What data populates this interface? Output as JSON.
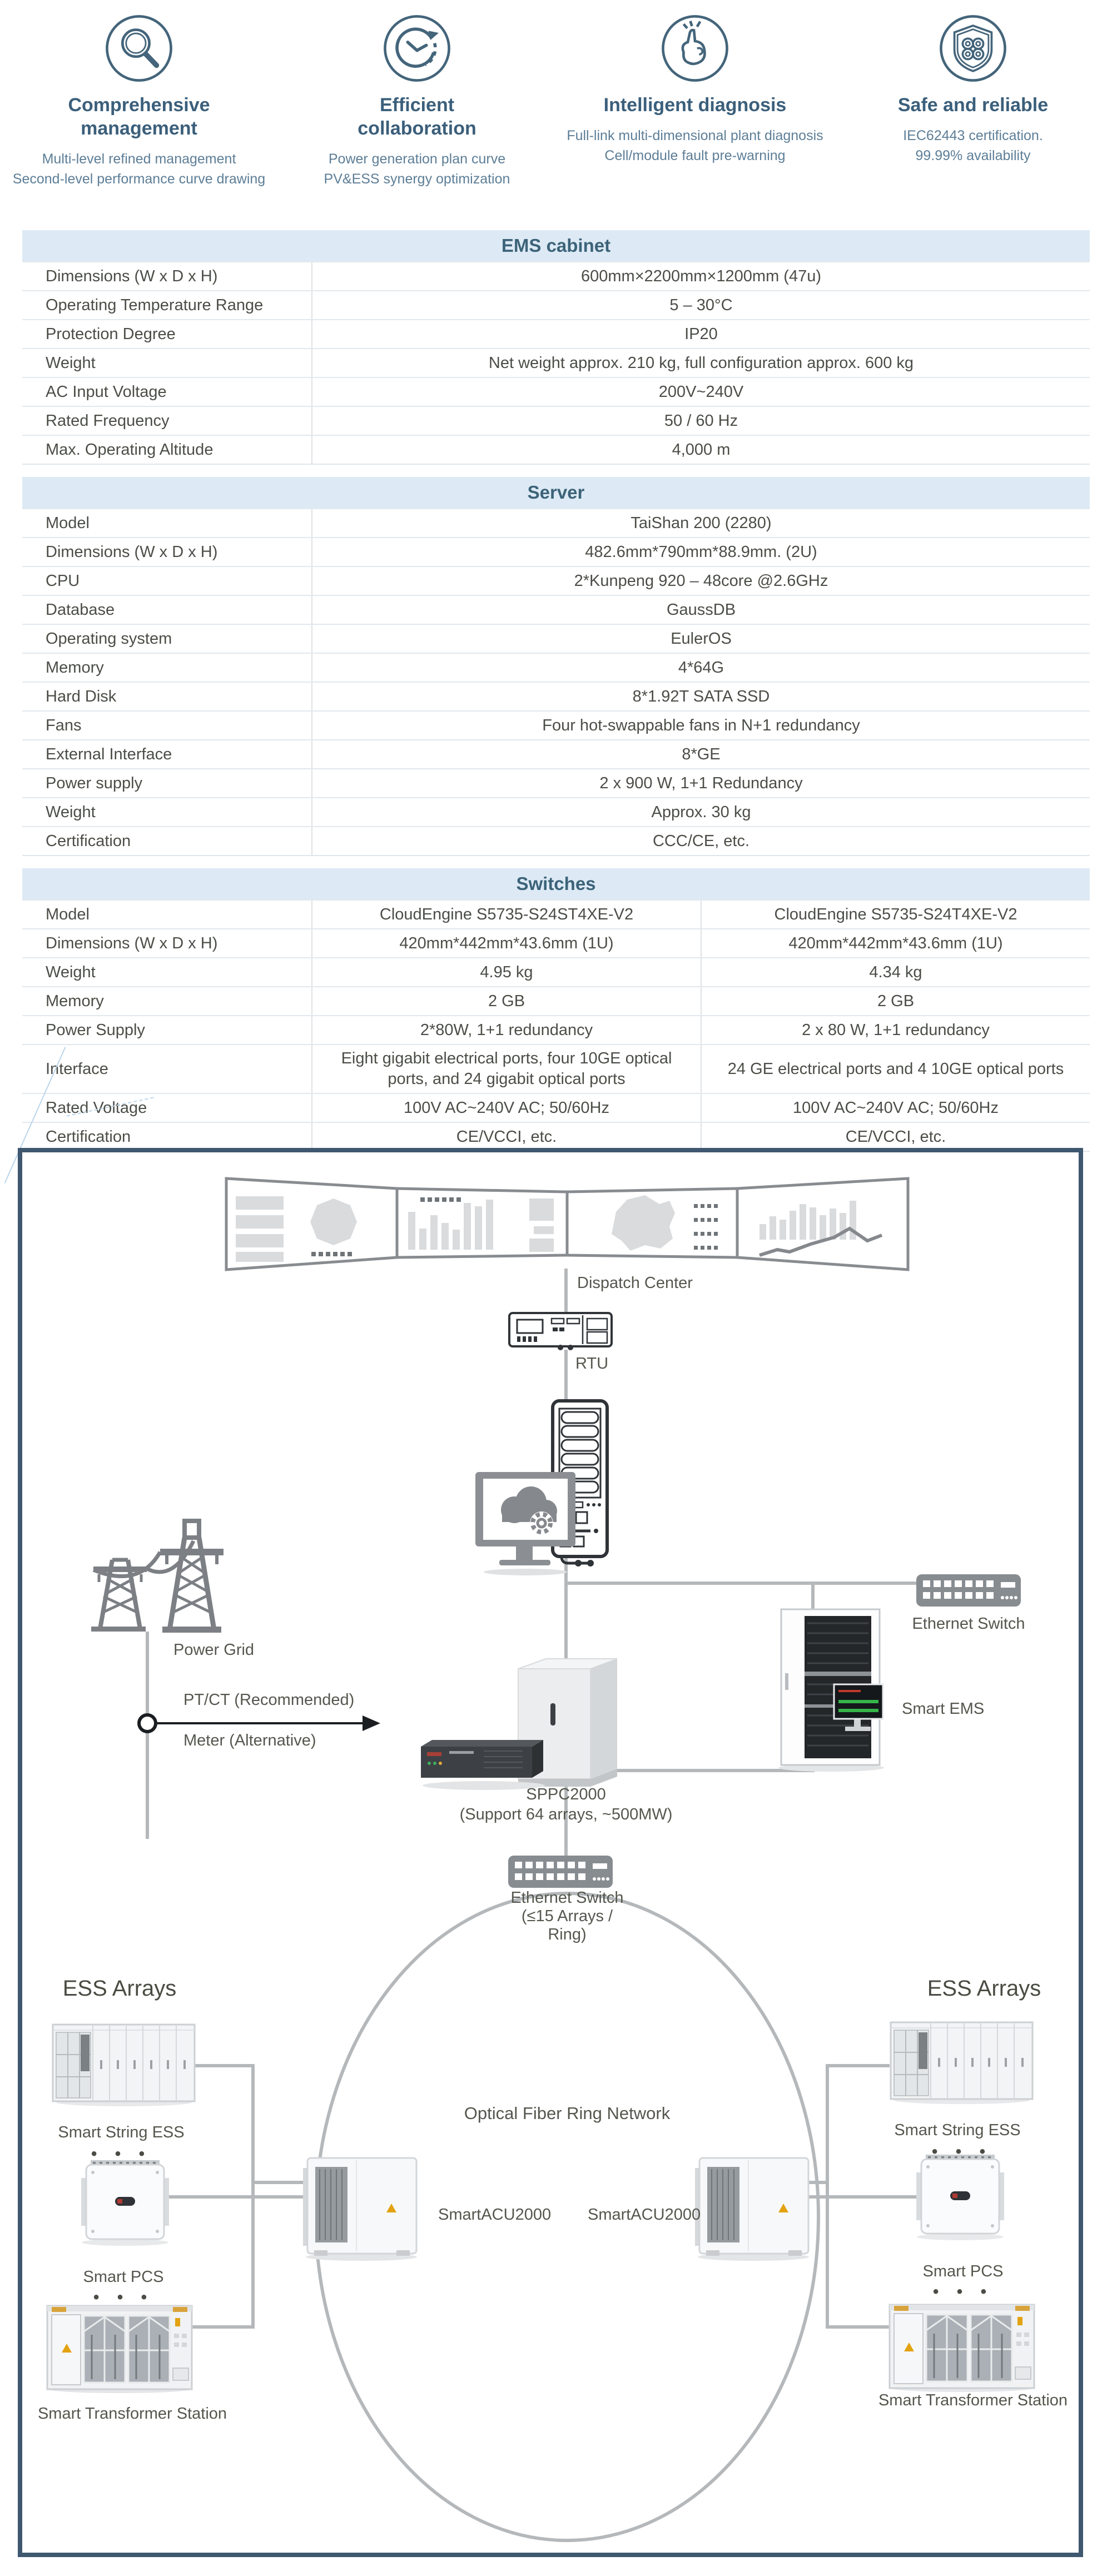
{
  "features": [
    {
      "icon": "magnifier-icon",
      "title": "Comprehensive management",
      "desc": "Multi-level refined management\nSecond-level performance curve drawing"
    },
    {
      "icon": "cycle-clock-icon",
      "title": "Efficient collaboration",
      "desc": "Power generation plan curve\nPV&ESS  synergy optimization"
    },
    {
      "icon": "snap-finger-icon",
      "title": "Intelligent diagnosis",
      "desc": "Full-link multi-dimensional plant diagnosis\nCell/module fault pre-warning"
    },
    {
      "icon": "shield-icon",
      "title": "Safe and reliable",
      "desc": "IEC62443 certification.\n99.99% availability"
    }
  ],
  "tables": {
    "ems": {
      "title": "EMS cabinet",
      "rows": [
        {
          "label": "Dimensions (W x D x H)",
          "value": "600mm×2200mm×1200mm (47u)"
        },
        {
          "label": "Operating Temperature Range",
          "value": "5 – 30°C"
        },
        {
          "label": "Protection Degree",
          "value": "IP20"
        },
        {
          "label": "Weight",
          "value": "Net weight approx. 210 kg, full configuration approx. 600 kg"
        },
        {
          "label": "AC Input Voltage",
          "value": "200V~240V"
        },
        {
          "label": "Rated Frequency",
          "value": "50 / 60 Hz"
        },
        {
          "label": "Max. Operating Altitude",
          "value": "4,000 m"
        }
      ]
    },
    "server": {
      "title": "Server",
      "rows": [
        {
          "label": "Model",
          "value": "TaiShan 200 (2280)"
        },
        {
          "label": "Dimensions (W x D x H)",
          "value": "482.6mm*790mm*88.9mm. (2U)"
        },
        {
          "label": "CPU",
          "value": "2*Kunpeng 920 – 48core @2.6GHz"
        },
        {
          "label": "Database",
          "value": "GaussDB"
        },
        {
          "label": "Operating system",
          "value": "EulerOS"
        },
        {
          "label": "Memory",
          "value": "4*64G"
        },
        {
          "label": "Hard Disk",
          "value": "8*1.92T SATA SSD"
        },
        {
          "label": "Fans",
          "value": "Four hot-swappable fans in N+1 redundancy"
        },
        {
          "label": "External Interface",
          "value": "8*GE"
        },
        {
          "label": "Power supply",
          "value": "2 x 900 W, 1+1 Redundancy"
        },
        {
          "label": "Weight",
          "value": "Approx. 30 kg"
        },
        {
          "label": "Certification",
          "value": "CCC/CE, etc."
        }
      ]
    },
    "switches": {
      "title": "Switches",
      "rows": [
        {
          "label": "Model",
          "values": [
            "CloudEngine S5735-S24ST4XE-V2",
            "CloudEngine S5735-S24T4XE-V2"
          ]
        },
        {
          "label": "Dimensions (W x D x H)",
          "values": [
            "420mm*442mm*43.6mm (1U)",
            "420mm*442mm*43.6mm (1U)"
          ]
        },
        {
          "label": "Weight",
          "values": [
            "4.95 kg",
            "4.34 kg"
          ]
        },
        {
          "label": "Memory",
          "values": [
            "2 GB",
            "2 GB"
          ]
        },
        {
          "label": "Power Supply",
          "values": [
            "2*80W, 1+1 redundancy",
            "2 x 80 W, 1+1 redundancy"
          ]
        },
        {
          "label": "Interface",
          "values": [
            "Eight gigabit electrical ports, four 10GE optical ports, and 24 gigabit optical ports",
            "24 GE electrical ports and 4 10GE optical ports"
          ]
        },
        {
          "label": "Rated Voltage",
          "values": [
            "100V AC~240V AC; 50/60Hz",
            "100V AC~240V AC; 50/60Hz"
          ]
        },
        {
          "label": "Certification",
          "values": [
            "CE/VCCI, etc.",
            "CE/VCCI, etc."
          ]
        }
      ]
    }
  },
  "diagram": {
    "dispatch_center": "Dispatch Center",
    "rtu": "RTU",
    "power_grid": "Power Grid",
    "ptct": "PT/CT (Recommended)",
    "meter": "Meter (Alternative)",
    "ethernet_switch": "Ethernet Switch",
    "smart_ems": "Smart EMS",
    "sppc2000": "SPPC2000",
    "sppc2000_sub": "(Support 64 arrays, ~500MW)",
    "mid_switch_l1": "Ethernet Switch",
    "mid_switch_l2": "(≤15 Arrays /",
    "mid_switch_l3": "Ring)",
    "ring": "Optical Fiber Ring Network",
    "ess_arrays": "ESS Arrays",
    "smart_string_ess": "Smart String ESS",
    "smart_pcs": "Smart PCS",
    "smart_acu": "SmartACU2000",
    "transformer": "Smart Transformer Station",
    "dots": "• • •"
  }
}
